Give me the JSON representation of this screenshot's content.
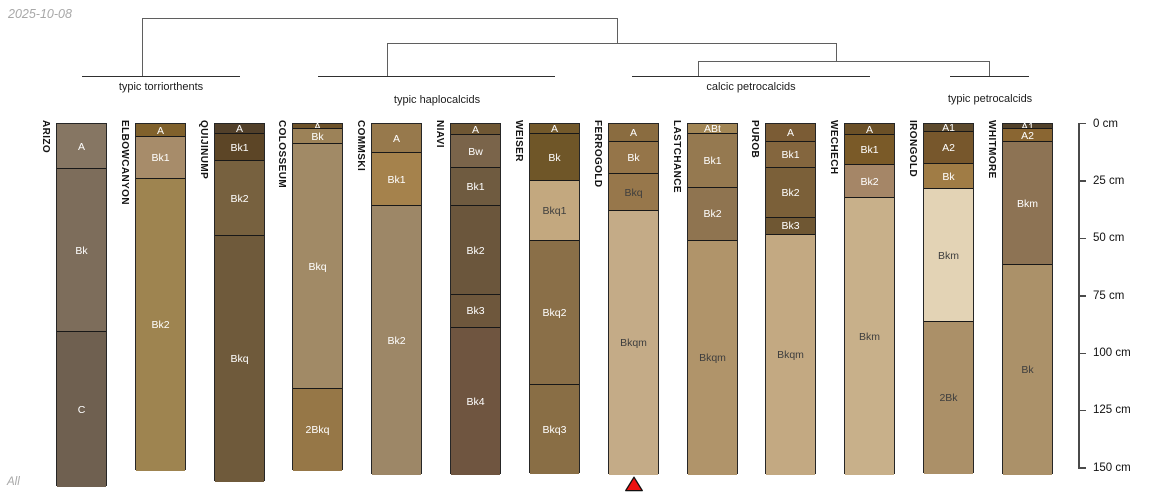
{
  "meta": {
    "date_label": "2025-10-08",
    "footer_label": "All"
  },
  "chart_data": {
    "type": "soil-profile-dendrogram",
    "title": "",
    "depth_axis": {
      "unit": "cm",
      "ticks": [
        0,
        25,
        50,
        75,
        100,
        125,
        150
      ],
      "tick_label_suffix": " cm",
      "x": 1078,
      "y0": 123,
      "px_per_cm": 2.2955,
      "tick_len": 8,
      "label_x": 1093
    },
    "dendrogram": {
      "segments": [
        [
          142,
          18,
          617,
          18
        ],
        [
          142,
          18,
          142,
          76
        ],
        [
          617,
          18,
          617,
          43
        ],
        [
          387,
          43,
          836,
          43
        ],
        [
          387,
          43,
          387,
          76
        ],
        [
          836,
          43,
          836,
          61
        ],
        [
          698,
          61,
          989,
          61
        ],
        [
          698,
          61,
          698,
          76
        ],
        [
          989,
          61,
          989,
          76
        ]
      ],
      "groups": [
        {
          "label": "typic torriorthents",
          "x1": 82,
          "x2": 240,
          "y": 76,
          "label_x": 161,
          "label_y": 81
        },
        {
          "label": "typic haplocalcids",
          "x1": 318,
          "x2": 555,
          "y": 76,
          "label_x": 437,
          "label_y": 94
        },
        {
          "label": "calcic petrocalcids",
          "x1": 632,
          "x2": 870,
          "y": 76,
          "label_x": 751,
          "label_y": 81
        },
        {
          "label": "typic petrocalcids",
          "x1": 950,
          "x2": 1029,
          "y": 76,
          "label_x": 990,
          "label_y": 93
        }
      ]
    },
    "column_width": 51,
    "profiles": [
      {
        "name": "ARIZO",
        "x": 56,
        "horizons": [
          {
            "label": "A",
            "top": 0,
            "bottom": 20,
            "color": "#867663",
            "text": "light"
          },
          {
            "label": "Bk",
            "top": 20,
            "bottom": 91,
            "color": "#7d6d5b",
            "text": "light"
          },
          {
            "label": "C",
            "top": 91,
            "bottom": 158,
            "color": "#6f6050",
            "text": "light"
          }
        ]
      },
      {
        "name": "ELBOWCANYON",
        "x": 135,
        "horizons": [
          {
            "label": "A",
            "top": 0,
            "bottom": 6,
            "color": "#80612c",
            "text": "light"
          },
          {
            "label": "Bk1",
            "top": 6,
            "bottom": 24,
            "color": "#a78c6a",
            "text": "light"
          },
          {
            "label": "Bk2",
            "top": 24,
            "bottom": 151,
            "color": "#9e8450",
            "text": "light"
          }
        ]
      },
      {
        "name": "QUIJINUMP",
        "x": 214,
        "horizons": [
          {
            "label": "A",
            "top": 0,
            "bottom": 4.5,
            "color": "#52402a",
            "text": "light"
          },
          {
            "label": "Bk1",
            "top": 4.5,
            "bottom": 16.5,
            "color": "#5c4526",
            "text": "light"
          },
          {
            "label": "Bk2",
            "top": 16.5,
            "bottom": 49,
            "color": "#77613f",
            "text": "light"
          },
          {
            "label": "Bkq",
            "top": 49,
            "bottom": 156,
            "color": "#6f5a3b",
            "text": "light"
          }
        ]
      },
      {
        "name": "COLOSSEUM",
        "x": 292,
        "horizons": [
          {
            "label": "A",
            "top": 0,
            "bottom": 2.5,
            "color": "#6d5229",
            "text": "light"
          },
          {
            "label": "Bk",
            "top": 2.5,
            "bottom": 9,
            "color": "#9c8258",
            "text": "light"
          },
          {
            "label": "Bkq",
            "top": 9,
            "bottom": 115.5,
            "color": "#a18a66",
            "text": "light"
          },
          {
            "label": "2Bkq",
            "top": 115.5,
            "bottom": 151,
            "color": "#967747",
            "text": "light"
          }
        ]
      },
      {
        "name": "COMMSKI",
        "x": 371,
        "horizons": [
          {
            "label": "A",
            "top": 0,
            "bottom": 13,
            "color": "#97794c",
            "text": "light"
          },
          {
            "label": "Bk1",
            "top": 13,
            "bottom": 36,
            "color": "#a5824c",
            "text": "light"
          },
          {
            "label": "Bk2",
            "top": 36,
            "bottom": 153,
            "color": "#9d8767",
            "text": "light"
          }
        ]
      },
      {
        "name": "NIAVI",
        "x": 450,
        "horizons": [
          {
            "label": "A",
            "top": 0,
            "bottom": 5,
            "color": "#6f5734",
            "text": "light"
          },
          {
            "label": "Bw",
            "top": 5,
            "bottom": 19.5,
            "color": "#7a644a",
            "text": "light"
          },
          {
            "label": "Bk1",
            "top": 19.5,
            "bottom": 36,
            "color": "#6f5b40",
            "text": "light"
          },
          {
            "label": "Bk2",
            "top": 36,
            "bottom": 74.5,
            "color": "#6b563c",
            "text": "light"
          },
          {
            "label": "Bk3",
            "top": 74.5,
            "bottom": 89,
            "color": "#6e573c",
            "text": "light"
          },
          {
            "label": "Bk4",
            "top": 89,
            "bottom": 153,
            "color": "#6f5540",
            "text": "light"
          }
        ]
      },
      {
        "name": "WEISER",
        "x": 529,
        "horizons": [
          {
            "label": "A",
            "top": 0,
            "bottom": 4.5,
            "color": "#73592b",
            "text": "light"
          },
          {
            "label": "Bk",
            "top": 4.5,
            "bottom": 25,
            "color": "#6f5628",
            "text": "light"
          },
          {
            "label": "Bkq1",
            "top": 25,
            "bottom": 51,
            "color": "#c3a87f",
            "text": "dark"
          },
          {
            "label": "Bkq2",
            "top": 51,
            "bottom": 114,
            "color": "#8a6f48",
            "text": "light"
          },
          {
            "label": "Bkq3",
            "top": 114,
            "bottom": 152.5,
            "color": "#896e45",
            "text": "light"
          }
        ]
      },
      {
        "name": "FERROGOLD",
        "x": 608,
        "horizons": [
          {
            "label": "A",
            "top": 0,
            "bottom": 8,
            "color": "#8a6c40",
            "text": "light"
          },
          {
            "label": "Bk",
            "top": 8,
            "bottom": 22,
            "color": "#957549",
            "text": "light"
          },
          {
            "label": "Bkq",
            "top": 22,
            "bottom": 38,
            "color": "#97774b",
            "text": "dark"
          },
          {
            "label": "Bkqm",
            "top": 38,
            "bottom": 153,
            "color": "#c4ab87",
            "text": "dark"
          }
        ]
      },
      {
        "name": "LASTCHANCE",
        "x": 687,
        "horizons": [
          {
            "label": "ABt",
            "top": 0,
            "bottom": 4.5,
            "color": "#a28655",
            "text": "light"
          },
          {
            "label": "Bk1",
            "top": 4.5,
            "bottom": 28,
            "color": "#957950",
            "text": "light"
          },
          {
            "label": "Bk2",
            "top": 28,
            "bottom": 51,
            "color": "#8f7450",
            "text": "light"
          },
          {
            "label": "Bkqm",
            "top": 51,
            "bottom": 153,
            "color": "#b0946a",
            "text": "dark"
          }
        ]
      },
      {
        "name": "PUROB",
        "x": 765,
        "horizons": [
          {
            "label": "A",
            "top": 0,
            "bottom": 8,
            "color": "#7b5c35",
            "text": "light"
          },
          {
            "label": "Bk1",
            "top": 8,
            "bottom": 19.5,
            "color": "#84663e",
            "text": "light"
          },
          {
            "label": "Bk2",
            "top": 19.5,
            "bottom": 41,
            "color": "#7b6039",
            "text": "light"
          },
          {
            "label": "Bk3",
            "top": 41,
            "bottom": 48.5,
            "color": "#6f5733",
            "text": "light"
          },
          {
            "label": "Bkqm",
            "top": 48.5,
            "bottom": 153,
            "color": "#c3a982",
            "text": "dark"
          }
        ]
      },
      {
        "name": "WECHECH",
        "x": 844,
        "horizons": [
          {
            "label": "A",
            "top": 0,
            "bottom": 5,
            "color": "#6b5027",
            "text": "light"
          },
          {
            "label": "Bk1",
            "top": 5,
            "bottom": 18,
            "color": "#7a5a28",
            "text": "light"
          },
          {
            "label": "Bk2",
            "top": 18,
            "bottom": 32.5,
            "color": "#a58667",
            "text": "light"
          },
          {
            "label": "Bkm",
            "top": 32.5,
            "bottom": 153,
            "color": "#c8b08a",
            "text": "dark"
          }
        ]
      },
      {
        "name": "IRONGOLD",
        "x": 923,
        "horizons": [
          {
            "label": "A1",
            "top": 0,
            "bottom": 3.5,
            "color": "#5d4a2d",
            "text": "light"
          },
          {
            "label": "A2",
            "top": 3.5,
            "bottom": 17.5,
            "color": "#77572c",
            "text": "light"
          },
          {
            "label": "Bk",
            "top": 17.5,
            "bottom": 28.5,
            "color": "#a07c45",
            "text": "light"
          },
          {
            "label": "Bkm",
            "top": 28.5,
            "bottom": 86.5,
            "color": "#e3d3b5",
            "text": "dark"
          },
          {
            "label": "2Bk",
            "top": 86.5,
            "bottom": 152.5,
            "color": "#ab9068",
            "text": "dark"
          }
        ]
      },
      {
        "name": "WHITMORE",
        "x": 1002,
        "horizons": [
          {
            "label": "A1",
            "top": 0,
            "bottom": 2.5,
            "color": "#51412a",
            "text": "light"
          },
          {
            "label": "A2",
            "top": 2.5,
            "bottom": 8,
            "color": "#8a6632",
            "text": "light"
          },
          {
            "label": "Bkm",
            "top": 8,
            "bottom": 61.5,
            "color": "#8d7354",
            "text": "light"
          },
          {
            "label": "Bk",
            "top": 61.5,
            "bottom": 153,
            "color": "#ab9169",
            "text": "dark"
          }
        ]
      }
    ],
    "marker": {
      "profile": "FERROGOLD",
      "x": 634,
      "y": 476,
      "color": "#ee1111"
    }
  }
}
